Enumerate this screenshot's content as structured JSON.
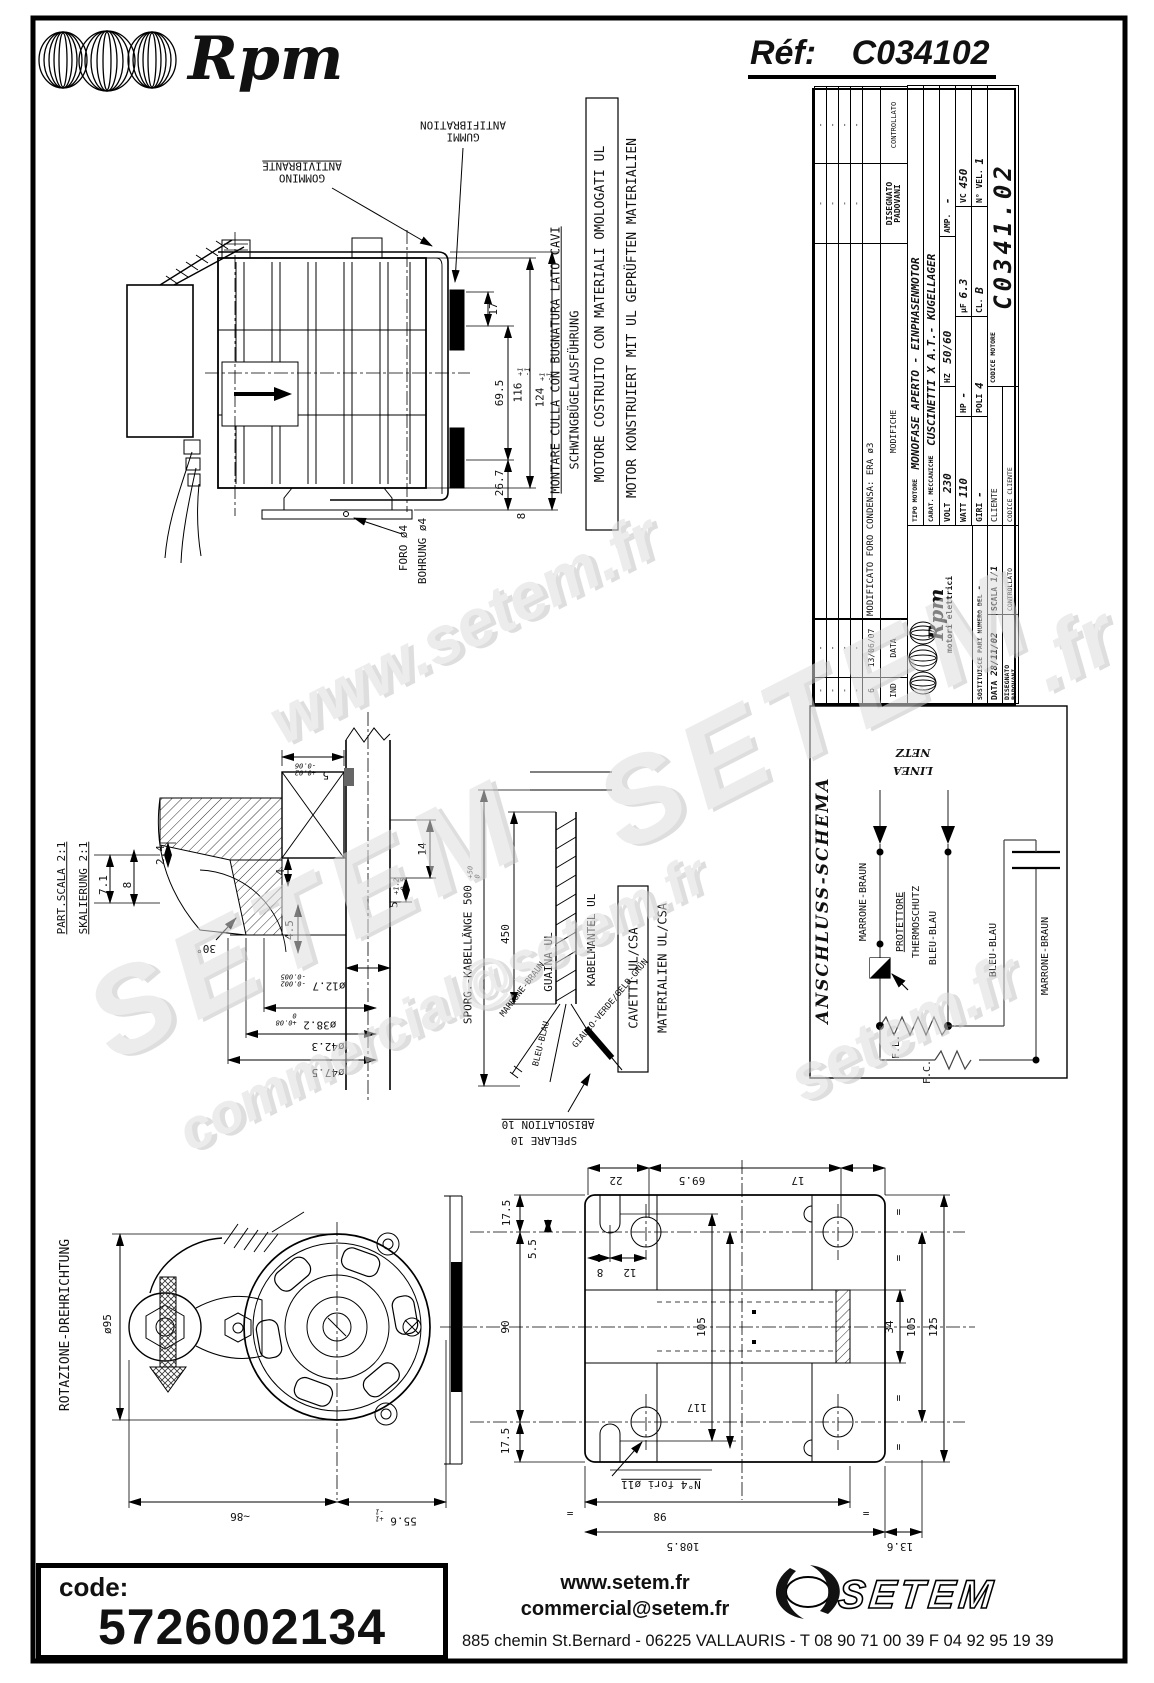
{
  "page": {
    "logo_text": "Rpm",
    "ref_label": "Réf:",
    "ref_value": "C034102"
  },
  "titleblock": {
    "dash": "-",
    "rev_ind": "6",
    "rev_date": "13/06/07",
    "rev_text": "MODIFICATO FORO CONDENSA: ERA ø3",
    "col_ind": "IND",
    "col_data": "DATA",
    "col_modifiche": "MODIFICHE",
    "disegnato_label": "DISEGNATO",
    "disegnato_value": "PADOVANI",
    "controllato_label": "CONTROLLATO",
    "tipo_label": "TIPO MOTORE",
    "tipo_value": "MONOFASE APERTO - EINPHASENMOTOR",
    "carat_label": "CARAT. MECCANICHE",
    "carat_value": "CUSCINETTI X A.T.- KUGELLAGER",
    "volt_label": "VOLT",
    "volt": "230",
    "hz_label": "HZ",
    "hz": "50/60",
    "amp_label": "AMP.",
    "amp": "-",
    "watt_label": "WATT",
    "watt": "110",
    "hp_label": "HP",
    "hp": "-",
    "uf_label": "µF",
    "uf": "6.3",
    "vc_label": "VC",
    "vc": "450",
    "giri_label": "GIRI",
    "giri": "-",
    "poli_label": "POLI",
    "poli": "4",
    "cl_label": "CL.",
    "cl": "B",
    "nvel_label": "N° VEL.",
    "nvel": "1",
    "cliente_label": "CLIENTE",
    "codcli_label": "CODICE CLIENTE",
    "codmot_label": "CODICE MOTORE",
    "codmot_value": "C0341.02",
    "rpm_logo": "Rpm",
    "rpm_sub": "motori elettrici",
    "sost_label": "SOSTITUISCE PARI NUMERO DEL",
    "sost_value": "-",
    "data_label": "DATA",
    "data_value": "28/11/02",
    "scala_label": "SCALA",
    "scala_value": "1/1"
  },
  "main_view": {
    "gommino": "GOMMINO",
    "antivibrante": "ANTIVIBRANTE",
    "gummi": "GUMMI",
    "antifibration": "ANTIFIBRATION",
    "montare": "MONTARE CULLA CON BUGNATURA LATO CAVI",
    "schwing": "SCHWINGBÜGELAUSFÜHRUNG",
    "ul_line1": "MOTORE COSTRUITO CON MATERIALI OMOLOGATI UL",
    "ul_line2": "MOTOR KONSTRUIERT MIT UL GEPRÜFTEN MATERIALIEN",
    "foro": "FORO ø4",
    "bohrung": "BOHRUNG ø4",
    "d17": "17",
    "d695": "69.5",
    "d116": "116",
    "d124": "124",
    "tol_p1": "+1",
    "tol_m1": "-1",
    "d267": "26.7",
    "d8": "8"
  },
  "detail_view": {
    "part_scala": "PART.SCALA 2:1",
    "skalierung": "SKALIERUNG 2:1",
    "d71": "7.1",
    "d8": "8",
    "d24": "2.4",
    "d4": "4",
    "d45": "4.5",
    "d30": "30°",
    "d5a": "5",
    "d5a_tp": "+0.02",
    "d5a_tm": "-0.06",
    "d14": "14",
    "d5b": "5",
    "d5b_tp": "+1.2",
    "d5b_tm": "-0.5",
    "d127": "ø12.7",
    "d127_tp": "-0.002",
    "d127_tm": "-0.005",
    "d382": "ø38.2",
    "d382_tp": "+0.08",
    "d382_tm": "0",
    "d423": "ø42.3",
    "d475": "ø47.5"
  },
  "cable_view": {
    "sporg": "SPORG.-KABELLÄNGE 500",
    "sporg_tp": "+50",
    "sporg_tm": "0",
    "d450": "450",
    "guaina": "GUAINA UL",
    "kabelmantel": "KABELMANTEL UL",
    "cavetti": "CAVETTI UL/CSA",
    "materialien": "MATERIALIEN UL/CSA",
    "marrone": "MARRONE-BRAUN",
    "bleu": "BLEU-BLAU",
    "giallo": "GIALLO-VERDE/GELB-GRÜN",
    "spelare": "SPELARE 10",
    "abisolation": "ABISOLATION 10"
  },
  "schema": {
    "title": "ANSCHLUSS-SCHEMA",
    "linea": "LINEA",
    "netz": "NETZ",
    "marrone1": "MARRONE-BRAUN",
    "protettore": "PROTETTORE",
    "thermoschutz": "THERMOSCHUTZ",
    "bleu1": "BLEU-BLAU",
    "bleu2": "BLEU-BLAU",
    "marrone2": "MARRONE-BRAUN",
    "fl": "F.L.",
    "fc": "F.C."
  },
  "front_view": {
    "rotazione": "ROTAZIONE-DREHRICHTUNG",
    "d95": "ø95",
    "d86": "~86",
    "d556": "55.6",
    "tol_p1": "+1",
    "tol_m1": "-1"
  },
  "plate_view": {
    "d175t": "17.5",
    "d55": "5.5",
    "d90": "90",
    "d175b": "17.5",
    "d22": "22",
    "d695": "69.5",
    "d17": "17",
    "d8": "8",
    "d12": "12",
    "d105l": "105",
    "d117": "117",
    "d34": "34",
    "d105r": "105",
    "d125": "125",
    "fori": "N°4 fori ø11",
    "d98": "98",
    "d1085": "108.5",
    "d136": "13.6",
    "eq": "="
  },
  "footer": {
    "code_label": "code:",
    "code_value": "5726002134",
    "web": "www.setem.fr",
    "email": "commercial@setem.fr",
    "brand": "SETEM",
    "address": "885 chemin St.Bernard  -  06225 VALLAURIS  -  T 08 90 71 00 39   F 04 92 95 19 39"
  },
  "watermarks": {
    "w1": "www.setem.fr",
    "w2": "SETEM",
    "w3": "SETEM",
    "w4": "commercial@setem.fr",
    "w5": "setem.fr",
    "w6": ".fr"
  }
}
